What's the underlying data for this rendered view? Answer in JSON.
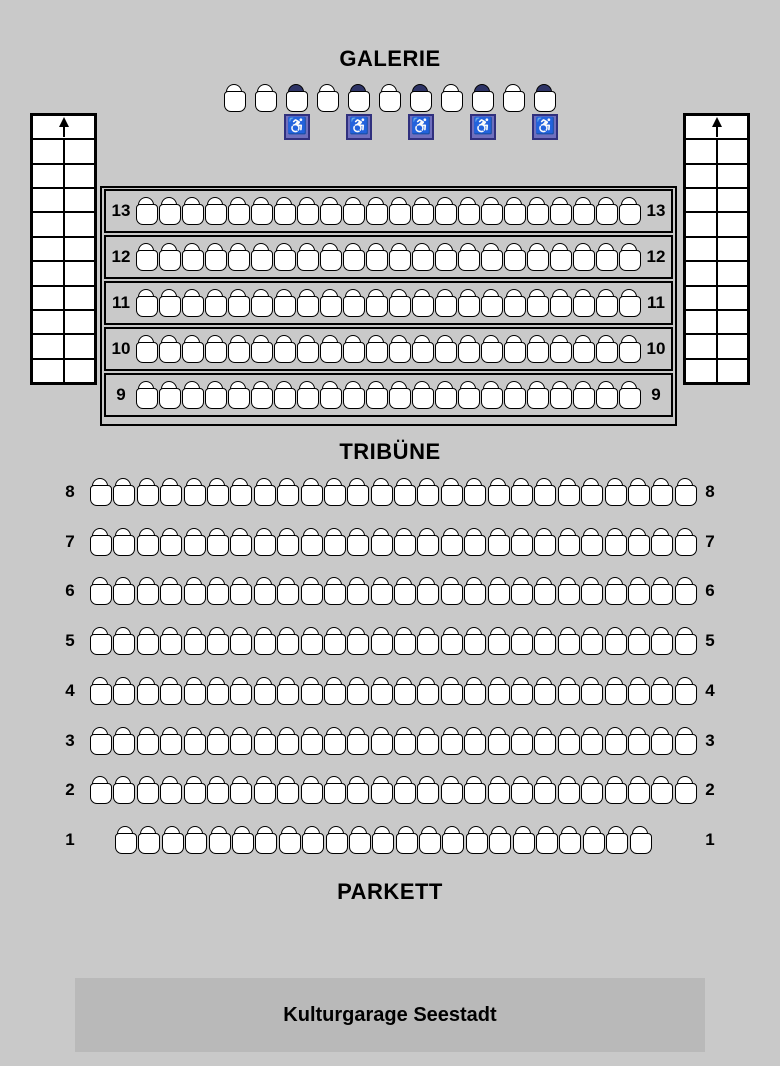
{
  "galerie": {
    "title": "GALERIE",
    "seat_count": 11,
    "wheelchair_seats": [
      3,
      5,
      7,
      9,
      11
    ]
  },
  "stairs_left": {
    "rows": 10,
    "cols": 2,
    "arrow": "up"
  },
  "stairs_right": {
    "rows": 10,
    "cols": 2,
    "arrow": "up"
  },
  "tribune": {
    "title": "TRIBÜNE",
    "rows": [
      {
        "number": "13",
        "seat_count": 22
      },
      {
        "number": "12",
        "seat_count": 22
      },
      {
        "number": "11",
        "seat_count": 22
      },
      {
        "number": "10",
        "seat_count": 22
      },
      {
        "number": "9",
        "seat_count": 22
      }
    ]
  },
  "parkett": {
    "title": "PARKETT",
    "rows": [
      {
        "number": "8",
        "seat_count": 26,
        "indent_px": 0
      },
      {
        "number": "7",
        "seat_count": 26,
        "indent_px": 0
      },
      {
        "number": "6",
        "seat_count": 26,
        "indent_px": 0
      },
      {
        "number": "5",
        "seat_count": 26,
        "indent_px": 0
      },
      {
        "number": "4",
        "seat_count": 26,
        "indent_px": 0
      },
      {
        "number": "3",
        "seat_count": 26,
        "indent_px": 0
      },
      {
        "number": "2",
        "seat_count": 26,
        "indent_px": 0
      },
      {
        "number": "1",
        "seat_count": 23,
        "indent_px": 25
      }
    ]
  },
  "stage": {
    "label": "Kulturgarage Seestadt"
  },
  "icons": {
    "wheelchair": "♿",
    "arrow_up": "up-arrow"
  },
  "colors": {
    "background": "#c9c9c9",
    "seat_fill": "#ffffff",
    "seat_border": "#000000",
    "wheelchair_badge": "#6f6fbe",
    "wheelchair_badge_border": "#30307e",
    "wheelchair_seat_back": "#2d3366",
    "stage_fill": "#b9b9b9"
  }
}
